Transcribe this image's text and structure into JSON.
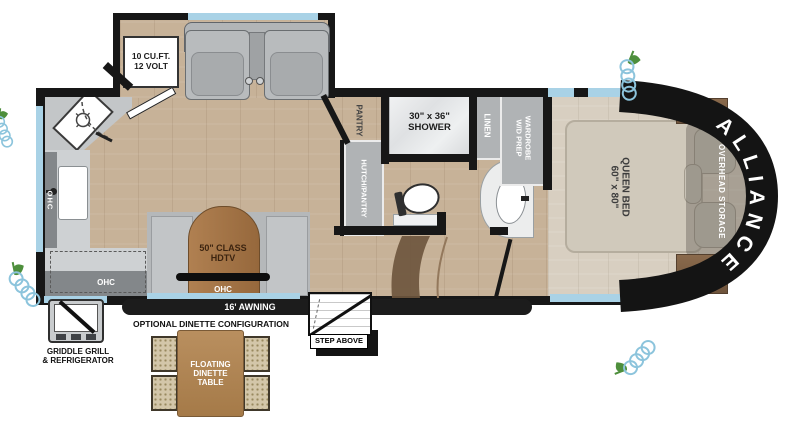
{
  "plan": {
    "brand": "ALLIANCE",
    "type": "rv-floorplan"
  },
  "labels": {
    "fridge": [
      "10 CU.FT.",
      "12 VOLT"
    ],
    "pantry": "PANTRY",
    "hutch": "HUTCH/PANTRY",
    "shower": [
      "30\" x 36\"",
      "SHOWER"
    ],
    "linen": "LINEN",
    "wardrobe": [
      "WARDROBE",
      "W/D PREP"
    ],
    "bed": [
      "QUEEN BED",
      "60\" x 80\""
    ],
    "overhead_storage": "OVERHEAD STORAGE",
    "nightstand": "NIGHTSTAND",
    "brand": "ALLIANCE",
    "tv": [
      "50\" CLASS",
      "HDTV"
    ],
    "ohc": "OHC",
    "awning": "16' AWNING",
    "step_above": "STEP ABOVE",
    "dinette_heading": "OPTIONAL DINETTE CONFIGURATION",
    "dinette_table": [
      "FLOATING",
      "DINETTE",
      "TABLE"
    ],
    "griddle": [
      "GRIDDLE GRILL",
      "& REFRIGERATOR"
    ]
  },
  "colors": {
    "wall": "#171717",
    "window": "#a9d2e6",
    "floor_main": "#c7b298",
    "floor_bedroom": "#d8cfc1",
    "cabinet_gray": "#b0b3b5",
    "ohc_gray": "#83878a",
    "wood_tv": "#a9794b",
    "wood_table": "#b08455",
    "nightstand_brown": "#7d5f45",
    "bed_beige": "#d0c9bb",
    "chair_tan": "#d3c6a9",
    "front_cap": "#141414",
    "coil_blue": "#8cc4dc",
    "sprout_green": "#4e8f3c"
  }
}
